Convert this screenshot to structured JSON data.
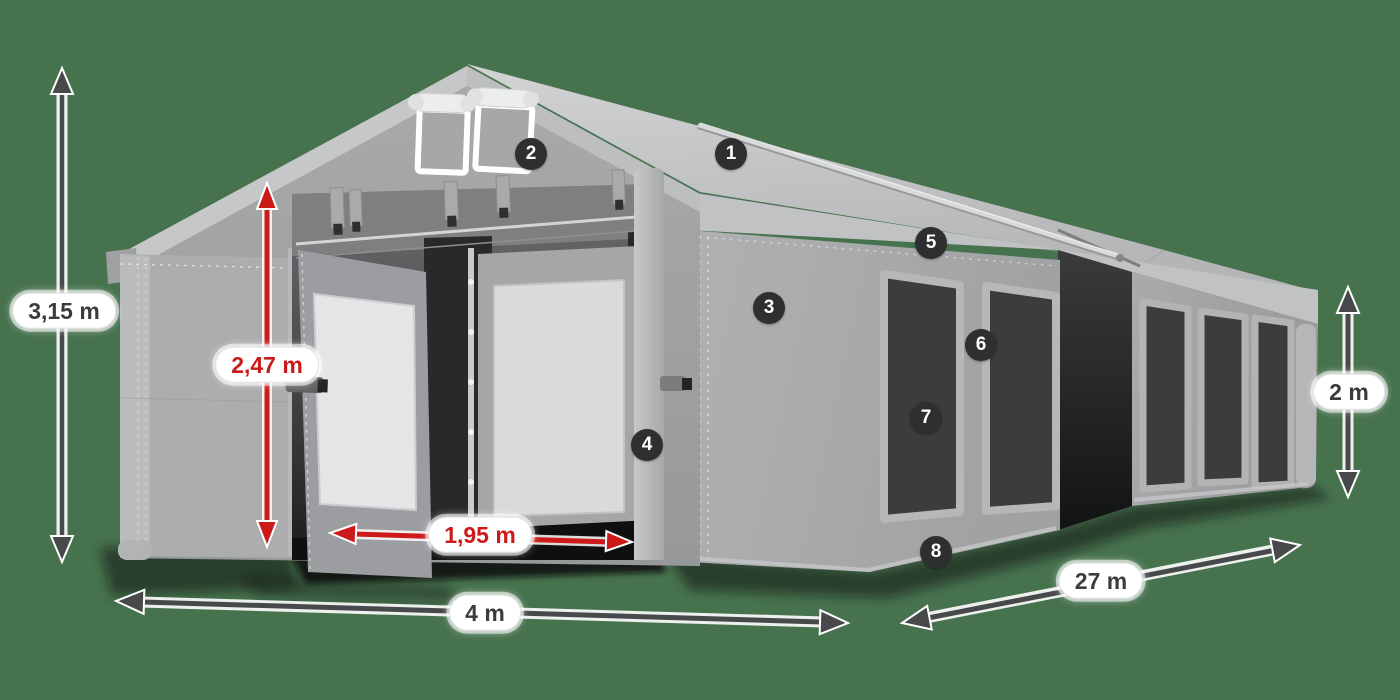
{
  "title": "Marquee tent dimensions diagram",
  "colors": {
    "background": "#47724E",
    "accent-red": "#CC1A1A",
    "arrow-dark": "#48494B",
    "badge-bg": "#2E2F31",
    "label-dark": "#3B3C3E",
    "label-bg": "#FFFFFF"
  },
  "dimension_labels": [
    {
      "id": "total-height",
      "text": "3,15 m",
      "style": "dark"
    },
    {
      "id": "entrance-height",
      "text": "2,47 m",
      "style": "red"
    },
    {
      "id": "entrance-width",
      "text": "1,95 m",
      "style": "red"
    },
    {
      "id": "tent-width",
      "text": "4 m",
      "style": "dark"
    },
    {
      "id": "tent-length",
      "text": "27 m",
      "style": "dark"
    },
    {
      "id": "side-wall-height",
      "text": "2 m",
      "style": "dark"
    }
  ],
  "callout_badges": [
    {
      "number": "1"
    },
    {
      "number": "2"
    },
    {
      "number": "3"
    },
    {
      "number": "4"
    },
    {
      "number": "5"
    },
    {
      "number": "6"
    },
    {
      "number": "7"
    },
    {
      "number": "8"
    }
  ]
}
